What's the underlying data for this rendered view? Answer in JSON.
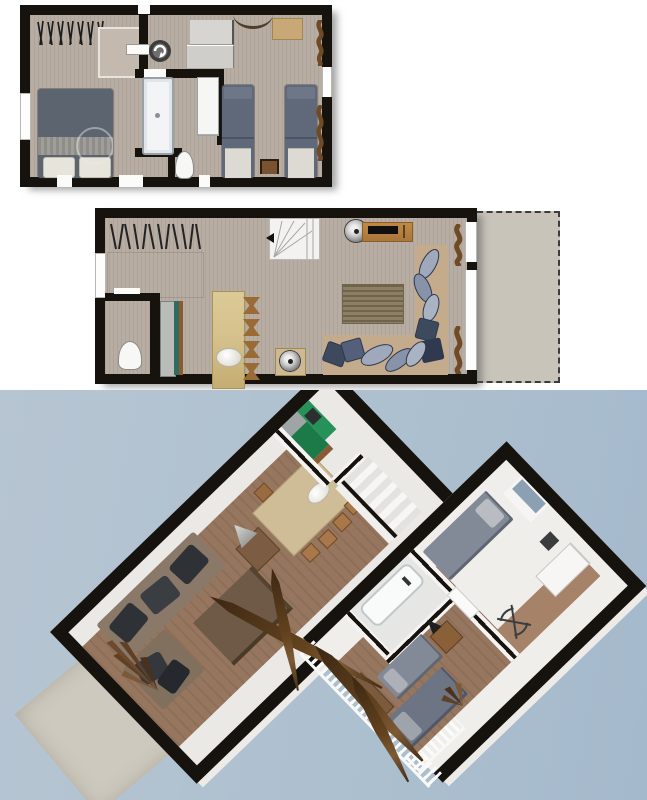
{
  "view": {
    "type": "architectural-floor-plan-render",
    "sections": [
      "upper-floor-2d-plan",
      "ground-floor-2d-plan",
      "3d-dollhouse-view"
    ],
    "visible_text": []
  },
  "palette": {
    "wall": "#16130f",
    "floor2d": "#b8ada3",
    "shower": "#c3b9ae",
    "terrace2d": "#c8c4ba",
    "duvet": "#5c6470",
    "duvetSingle": "#5f6979",
    "linen": "#e7e4dc",
    "blanket": "#95938f",
    "tub": "#f2f4f6",
    "tubEdge": "#98a0a8",
    "grayFurn": "#d6d5d2",
    "deskWood": "#c9a877",
    "darkWood": "#7a5230",
    "curtain": "#6e4b26",
    "stoolWood": "#9a6b35",
    "tableTan": "#d5c28d",
    "counterGray": "#b9bcb8",
    "counterTeal": "#2f6b5f",
    "rug": "#8d7f63",
    "sofaTan": "#c3ab8c",
    "cushLight": "#9fa9bb",
    "cushDark": "#3d4a5e",
    "metal": "#c9c9c9",
    "bg3dA": "#b7c5d2",
    "bg3dB": "#a4b9cc",
    "terrace3d": "#cdc9be",
    "light3d": "#ebe9e5",
    "wood3d": "#96765f",
    "green1": "#1c7a49",
    "green2": "#27915a",
    "bed3d": "#838a97",
    "bed3dDark": "#6d7484",
    "sofa3d": "#8a7869",
    "cushion3d": "#2e3135",
    "table3d": "#6f5a47",
    "tan3d": "#cfbd97",
    "plantBrown": "#63431f",
    "glass3d": "#8ba0b2"
  },
  "plans": {
    "upper_floor_2d": {
      "position": "top",
      "rooms": [
        {
          "name": "master-bedroom",
          "furniture": [
            "double-bed",
            "clothes-rail",
            "shower-cabin",
            "window"
          ]
        },
        {
          "name": "landing",
          "furniture": [
            "washing-machine",
            "gray-dressers",
            "wall-arc-shelf",
            "wood-desk"
          ]
        },
        {
          "name": "bathroom",
          "furniture": [
            "bathtub",
            "toilet",
            "wardrobe"
          ]
        },
        {
          "name": "twin-bedroom",
          "furniture": [
            "single-bed",
            "single-bed",
            "nightstand",
            "curtains",
            "window"
          ]
        }
      ]
    },
    "ground_floor_2d": {
      "position": "middle",
      "rooms": [
        {
          "name": "entry",
          "furniture": [
            "coat-rack",
            "window"
          ]
        },
        {
          "name": "wc",
          "furniture": [
            "toilet"
          ]
        },
        {
          "name": "kitchen",
          "furniture": [
            "counter-teal-front"
          ]
        },
        {
          "name": "dining-area",
          "furniture": [
            "dining-table",
            "stool",
            "stool",
            "stool",
            "stool",
            "bowl"
          ]
        },
        {
          "name": "living-room",
          "furniture": [
            "winder-stairs",
            "direction-arrow",
            "sideboard",
            "tv-bar",
            "speaker-disc",
            "rug",
            "corner-sofa",
            "scatter-cushions",
            "side-table",
            "fan-disc",
            "curtains",
            "sliding-window-wall"
          ]
        },
        {
          "name": "terrace",
          "style": "dashed-outline",
          "furniture": []
        }
      ]
    },
    "view_3d": {
      "position": "bottom",
      "slabs": [
        {
          "name": "ground-floor-3d",
          "items": [
            "corner-sofa",
            "dark-cushions",
            "coffee-table",
            "floor-lamp",
            "side-table",
            "dining-table",
            "stools",
            "kitchen-green-unit",
            "sink",
            "stairs",
            "interior-walls",
            "plant",
            "patio-slab",
            "door-opening"
          ]
        },
        {
          "name": "upper-floor-3d",
          "items": [
            "bed",
            "bed",
            "bed",
            "bathtub",
            "white-dresser",
            "nightstand",
            "lamp",
            "wardrobe",
            "wire-chair",
            "balcony-railing",
            "plant-fronds",
            "wall-window"
          ]
        }
      ]
    }
  }
}
